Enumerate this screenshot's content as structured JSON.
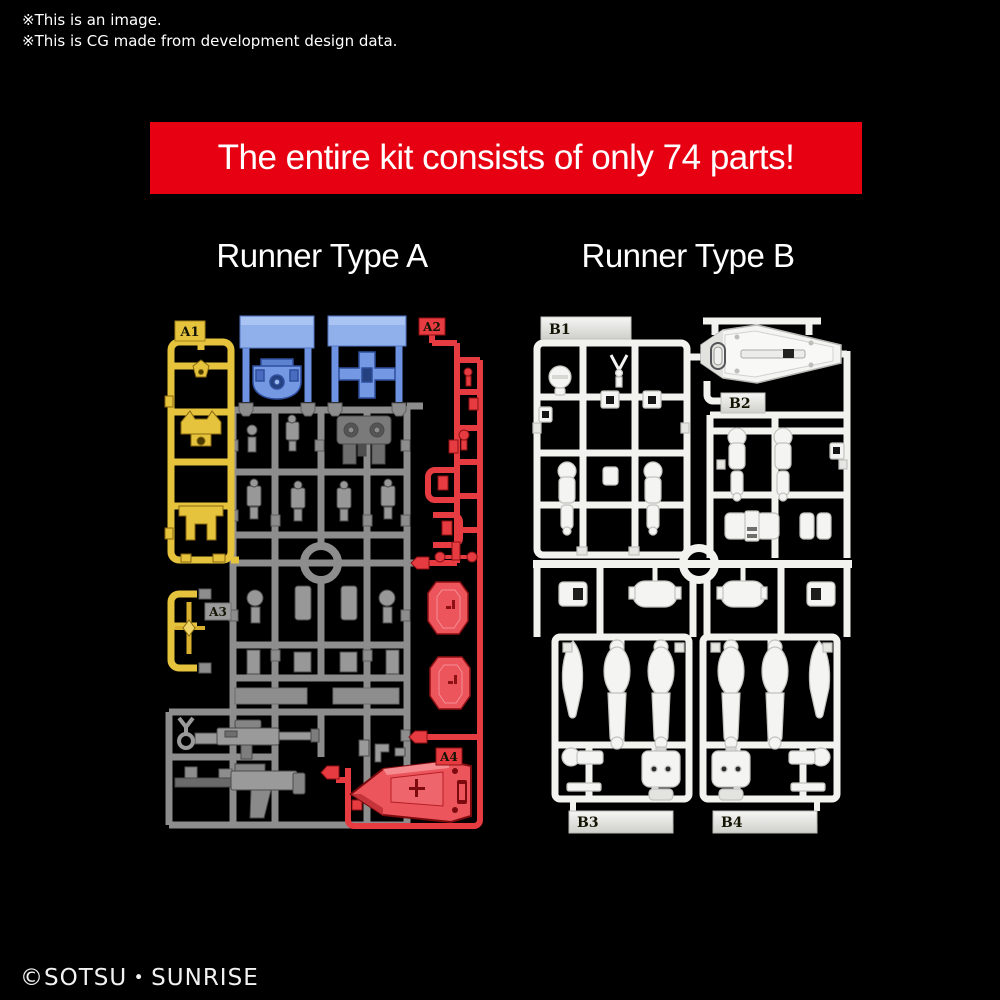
{
  "image_notes": {
    "line1": "※This is an image.",
    "line2": "※This is CG made from development design data."
  },
  "banner": {
    "text": "The entire kit consists of only 74 parts!",
    "bg": "#e60012",
    "fg": "#ffffff"
  },
  "runner_a": {
    "title": "Runner Type A",
    "tags": {
      "a1": "A1",
      "a2": "A2",
      "a3": "A3",
      "a4": "A4"
    },
    "colors": {
      "yellow": "#e6c33c",
      "blue": "#7598e2",
      "gray": "#8d8d8d",
      "red": "#e73b42"
    }
  },
  "runner_b": {
    "title": "Runner Type B",
    "tags": {
      "b1": "B1",
      "b2": "B2",
      "b3": "B3",
      "b4": "B4"
    },
    "colors": {
      "white": "#f2f2ef"
    }
  },
  "footer": {
    "copyright": "©SOTSU・SUNRISE"
  }
}
